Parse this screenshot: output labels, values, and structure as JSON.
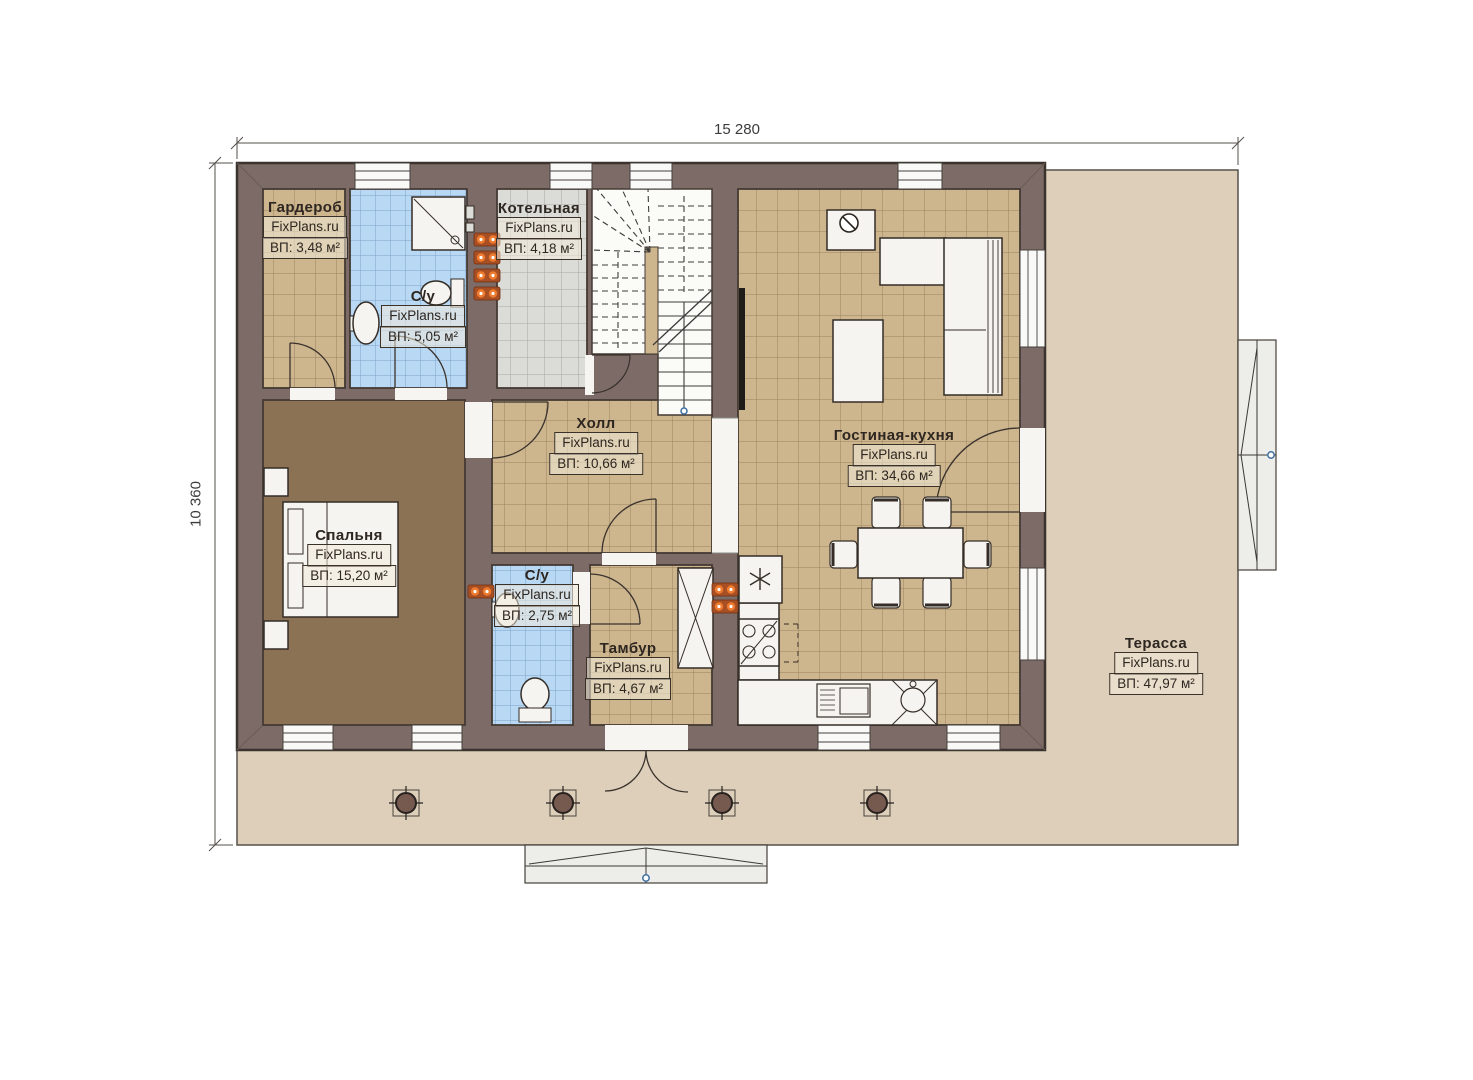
{
  "page": {
    "type": "architectural-floor-plan",
    "background": "#ffffff"
  },
  "dimensions": {
    "width_label": "15 280",
    "height_label": "10 360"
  },
  "watermark_site": "FixPlans.ru",
  "rooms": [
    {
      "id": "wardrobe",
      "name": "Гардероб",
      "watermark": "FixPlans.ru",
      "area": "ВП: 3,48 м²"
    },
    {
      "id": "bathroom-top",
      "name": "С/у",
      "watermark": "FixPlans.ru",
      "area": "ВП: 5,05 м²"
    },
    {
      "id": "boiler-room",
      "name": "Котельная",
      "watermark": "FixPlans.ru",
      "area": "ВП: 4,18 м²"
    },
    {
      "id": "hall",
      "name": "Холл",
      "watermark": "FixPlans.ru",
      "area": "ВП: 10,66 м²"
    },
    {
      "id": "bedroom",
      "name": "Спальня",
      "watermark": "FixPlans.ru",
      "area": "ВП: 15,20 м²"
    },
    {
      "id": "bathroom-bottom",
      "name": "С/у",
      "watermark": "FixPlans.ru",
      "area": "ВП: 2,75 м²"
    },
    {
      "id": "vestibule",
      "name": "Тамбур",
      "watermark": "FixPlans.ru",
      "area": "ВП: 4,67 м²"
    },
    {
      "id": "living-kitchen",
      "name": "Гостиная-кухня",
      "watermark": "FixPlans.ru",
      "area": "ВП: 34,66 м²"
    },
    {
      "id": "terrace",
      "name": "Терасса",
      "watermark": "FixPlans.ru",
      "area": "ВП: 47,97 м²"
    }
  ],
  "colors": {
    "wall": "#7d6b67",
    "wall_outline": "#3b332e",
    "tile_tan": "#cdb58d",
    "tile_blue": "#b9d8f3",
    "tile_gray": "#dbdbd8",
    "bedroom_floor": "#8b7254",
    "terrace": "#ddcfba",
    "radiator_orange": "#ef7b2e",
    "furniture_white": "#f5f4f0",
    "steps_gray": "#ededea"
  }
}
